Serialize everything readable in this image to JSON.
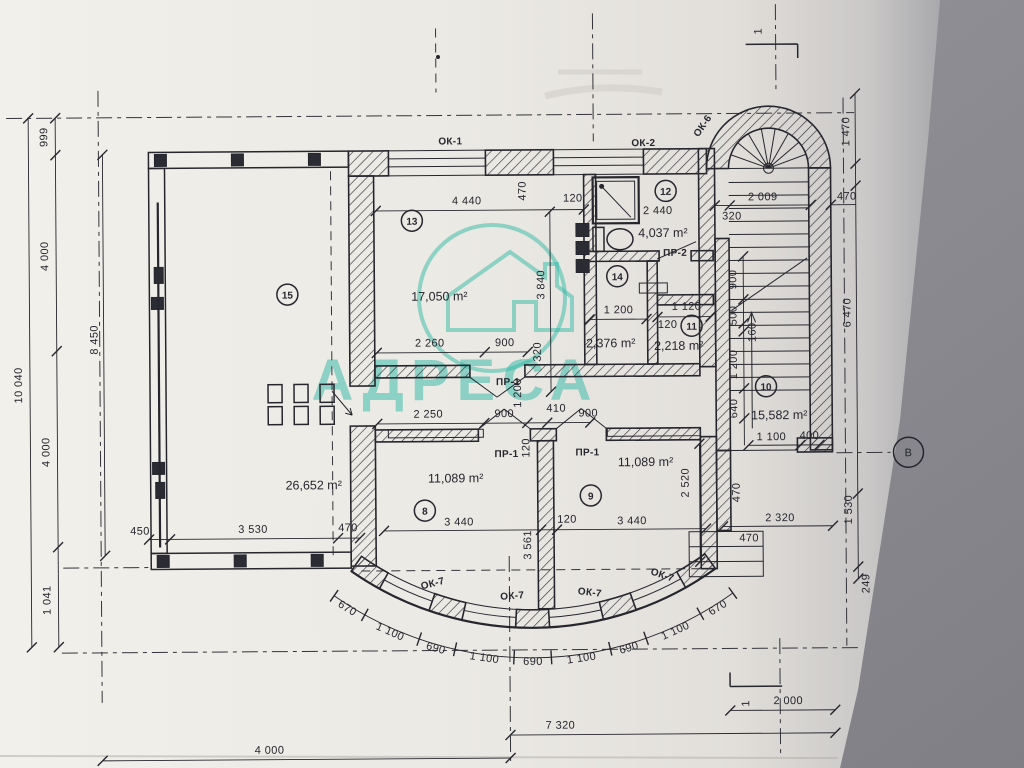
{
  "document_type": "floor-plan scan",
  "watermark": {
    "text": "АДРЕСА",
    "color": "#2fb9a8"
  },
  "paper_color": "#efece6",
  "background_color": "#8f8f95",
  "ink_color": "#26272e",
  "rooms": {
    "r8": {
      "num": "8",
      "area": "11,089 m²"
    },
    "r9": {
      "num": "9",
      "area": "11,089 m²"
    },
    "r10": {
      "num": "10",
      "area": "15,582 m²"
    },
    "r11": {
      "num": "11",
      "area": "2,218 m²"
    },
    "r12": {
      "num": "12",
      "area": "4,037 m²",
      "width": "2 440"
    },
    "r13": {
      "num": "13",
      "area": "17,050 m²"
    },
    "r14": {
      "num": "14",
      "area": "2,376 m²"
    },
    "r15": {
      "num": "15",
      "area": "26,652 m²"
    }
  },
  "openings": {
    "ok1": "ОК-1",
    "ok2": "ОК-2",
    "ok6": "ОК-6",
    "ok7": "ОК-7",
    "pr1": "ПР-1",
    "pr2": "ПР-2"
  },
  "markers": {
    "axis_b": "В",
    "section_1": "1"
  },
  "dims": {
    "left": [
      "999",
      "4 000",
      "4 000",
      "1 041"
    ],
    "left_total": "10 040",
    "left_inner": "8 450",
    "right": [
      "1 470",
      "470",
      "6 470",
      "1 530",
      "249"
    ],
    "bottom": [
      "4 000",
      "7 320",
      "2 000"
    ],
    "arc": [
      "670",
      "1 100",
      "690",
      "1 100",
      "690",
      "1 100",
      "690",
      "1 100",
      "670"
    ],
    "room13": {
      "top": "4 440",
      "wall470": "470",
      "wall120": "120",
      "height": "3 840",
      "b1": "2 260",
      "b2": "900",
      "b3": "320"
    },
    "room14": {
      "w": "1 200",
      "w11": "1 120",
      "wall": "120"
    },
    "corridor": {
      "c1": "2 250",
      "c2": "900",
      "c3": "410",
      "c4": "900",
      "v": "1 200",
      "wall": "120"
    },
    "rooms89": {
      "w8": "3 440",
      "wall": "120",
      "w9": "3 440",
      "v": "3 561",
      "v9": "2 520"
    },
    "stairs": {
      "top": "2 009",
      "t320": "320",
      "v1": "900",
      "v2": "500",
      "v3": "160",
      "v4": "1 200",
      "v5": "640",
      "h1": "1 100",
      "h2": "400",
      "v6": "470",
      "b1": "2 320",
      "b2": "470"
    },
    "terrace": {
      "t1": "450",
      "t2": "3 530",
      "t3": "470"
    }
  }
}
